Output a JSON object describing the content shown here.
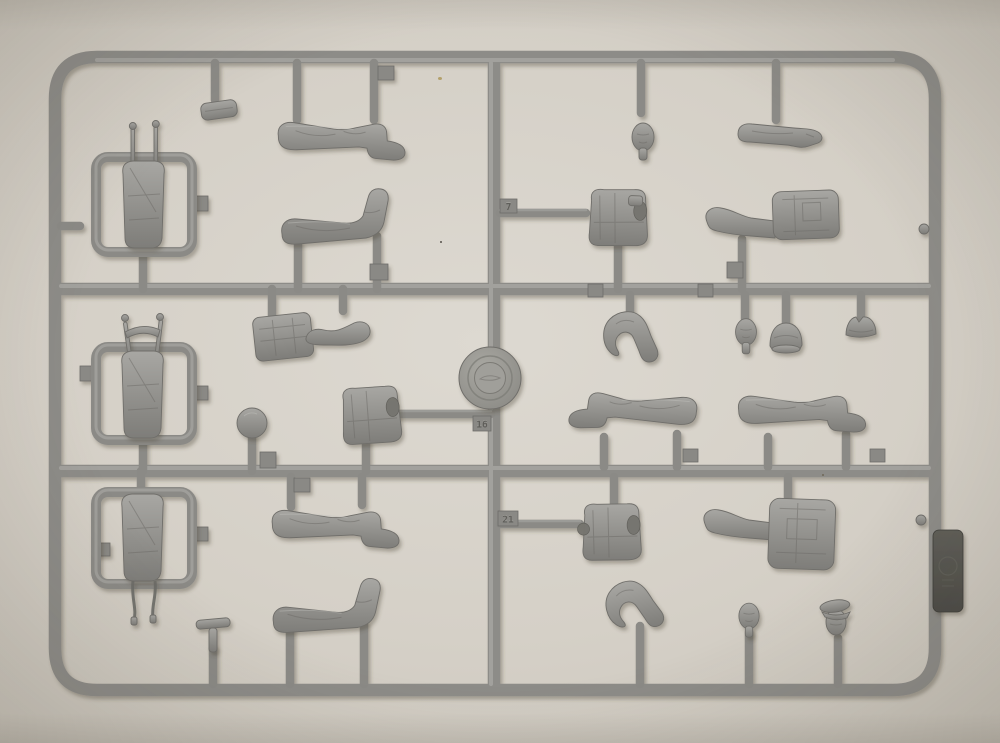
{
  "photo": {
    "alt": "Photograph of a light-gray injection-molded plastic sprue of 1/35 figure model parts on a beige paper background",
    "colors": {
      "background": "#d4cfc6",
      "plastic": "#8d8c88",
      "plastic_highlight": "#a6a5a1",
      "plastic_shadow": "#6f6e6a",
      "label_tab": "#55544e"
    }
  },
  "sprue": {
    "material": "gray styrene",
    "mold_stamp": {
      "label": "circular mold stamp, emboss illegible"
    },
    "label_tab": {
      "label": "dark embossed manufacturer tab, illegible"
    },
    "part_number_tags": {
      "tag_a": "7",
      "tag_b": "16",
      "tag_c": "21",
      "illegible_1": "",
      "illegible_2": "",
      "illegible_3": "",
      "illegible_4": ""
    },
    "parts": [
      {
        "label": "small pouch"
      },
      {
        "label": "leg with boot, top row"
      },
      {
        "label": "leg with raised boot, top row"
      },
      {
        "label": "bicycle-rider torso in protective frame, top left"
      },
      {
        "label": "bicycle-rider torso in protective frame, middle left"
      },
      {
        "label": "bicycle-rider torso with hanging straps in protective frame, bottom left"
      },
      {
        "label": "backpack with bent arm"
      },
      {
        "label": "plain torso"
      },
      {
        "label": "helmet dome"
      },
      {
        "label": "bare head, top right"
      },
      {
        "label": "extended arm"
      },
      {
        "label": "torso with field gear, upper right"
      },
      {
        "label": "torso with attached arm and pack, upper right"
      },
      {
        "label": "arm bent at elbow"
      },
      {
        "label": "head"
      },
      {
        "label": "field cap"
      },
      {
        "label": "side cap"
      },
      {
        "label": "leg, boot to left"
      },
      {
        "label": "leg, boot to right"
      },
      {
        "label": "torso with field gear, lower right"
      },
      {
        "label": "torso with attached arm, lower right"
      },
      {
        "label": "bent arm with open hand"
      },
      {
        "label": "head, bottom right"
      },
      {
        "label": "head with peaked cap"
      },
      {
        "label": "leg, bottom middle"
      },
      {
        "label": "leg with raised boot, bottom middle"
      },
      {
        "label": "small T-shaped tool"
      }
    ]
  }
}
